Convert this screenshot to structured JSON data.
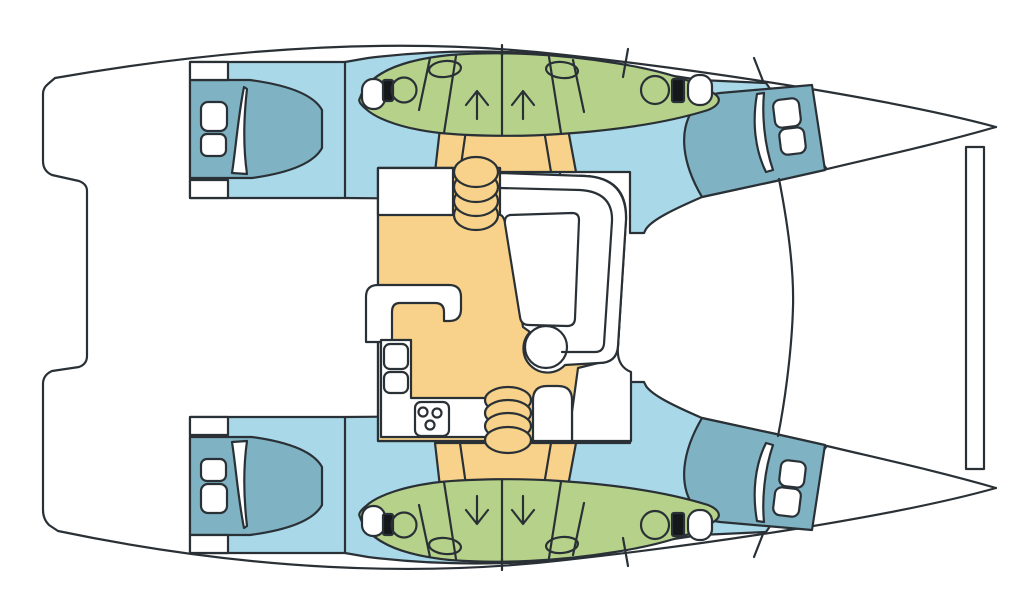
{
  "diagram": {
    "type": "boat-deck-plan",
    "subject": "sailing catamaran interior layout, top view, bows to the right",
    "hulls": 2,
    "cabins": 4,
    "bathroom_pods": 2,
    "toilets": 4,
    "washbasins": 4,
    "shower_stalls_with_arrows": 4,
    "salon_features": [
      "galley counter",
      "double galley sink",
      "stove with 3 burners",
      "c-shaped dinette settee",
      "dinette table",
      "round end seat",
      "companionway steps forward",
      "companionway steps aft"
    ],
    "deck_features": [
      "forward crossbeam",
      "trampoline area",
      "stepped aft platform",
      "coachroof front edge"
    ]
  },
  "colors": {
    "outline": "#2A3136",
    "walkway": "#A9D8E8",
    "bed": "#7FB2C3",
    "bathroom": "#B6D28A",
    "salon_floor": "#F8D28A",
    "fixture_white": "#FFFFFF",
    "tank_black": "#15181B"
  }
}
